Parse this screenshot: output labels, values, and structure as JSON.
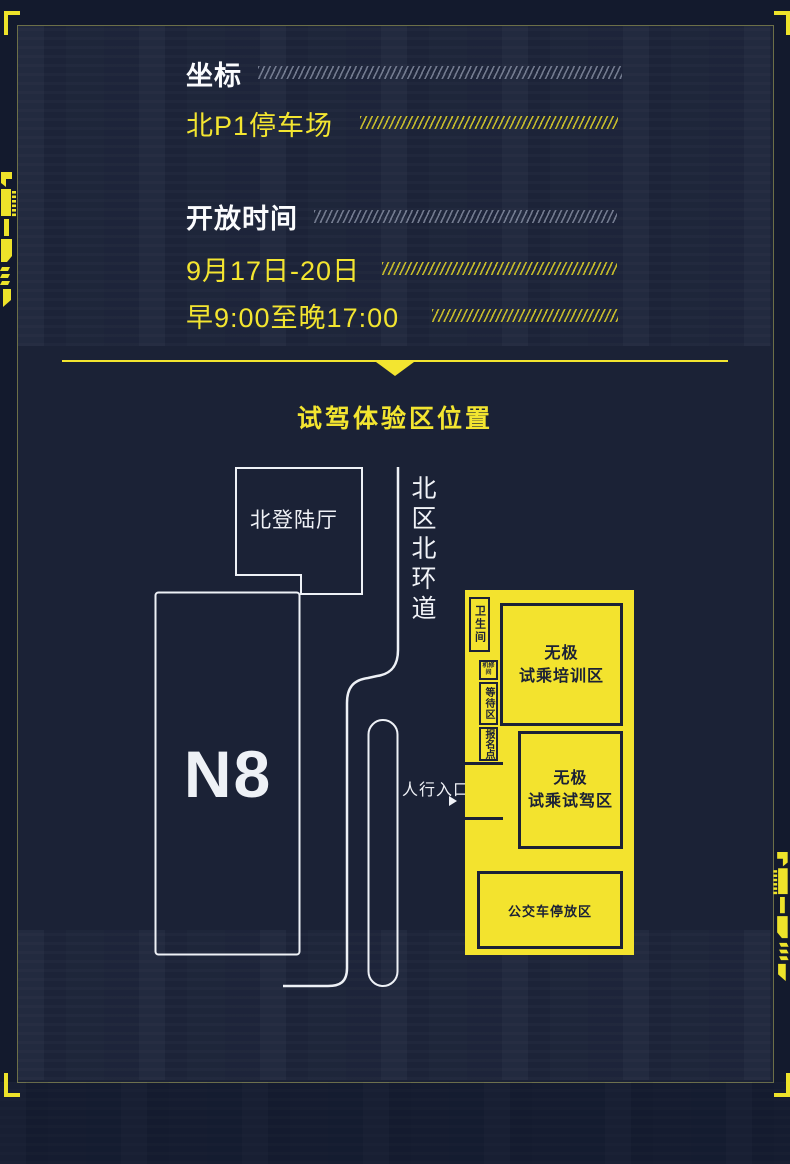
{
  "info": {
    "coordinate_label": "坐标",
    "coordinate_value": "北P1停车场",
    "hours_label": "开放时间",
    "hours_dates": "9月17日-20日",
    "hours_time": "早9:00至晚17:00"
  },
  "map": {
    "title": "试驾体验区位置",
    "north_hall": "北登陆厅",
    "ring_road": "北区北环道",
    "building_n8": "N8",
    "pedestrian_entrance": "人行入口",
    "restroom": "卫生间",
    "machine_room": "机修间",
    "waiting_area": "等待区",
    "registration_point": "报名点",
    "training_zone_line1": "无极",
    "training_zone_line2": "试乘培训区",
    "test_drive_zone_line1": "无极",
    "test_drive_zone_line2": "试乘试驾区",
    "bus_parking_zone": "公交车停放区"
  },
  "colors": {
    "accent_yellow": "#f3e32e",
    "background_navy": "#131a2d",
    "panel_navy": "#1b2236",
    "line_white": "#f0f2f7",
    "dark_outline": "#1b2136"
  }
}
